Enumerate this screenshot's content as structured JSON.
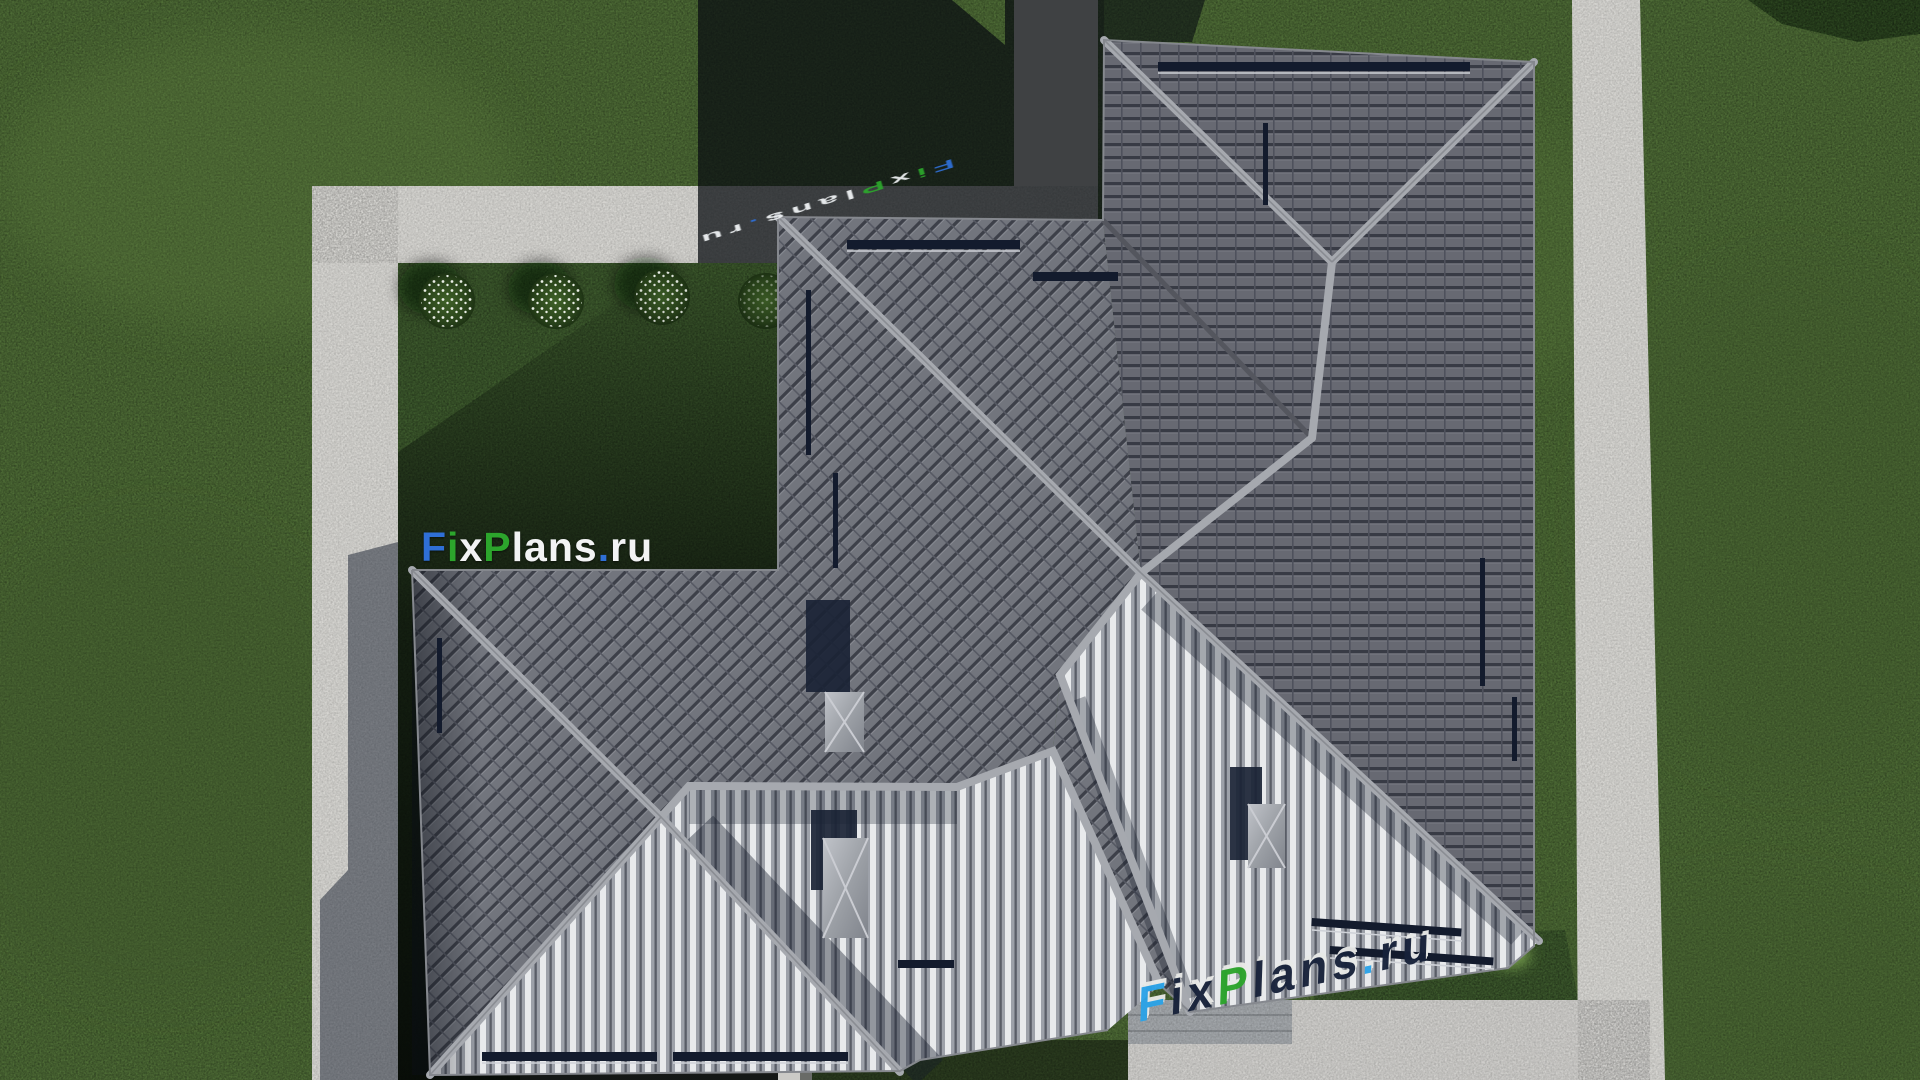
{
  "watermarks": {
    "logo_text": "FixPlans.ru",
    "letters": [
      {
        "ch": "F",
        "c": "blue"
      },
      {
        "ch": "i",
        "c": "green"
      },
      {
        "ch": "x",
        "c": "white"
      },
      {
        "ch": "P",
        "c": "green"
      },
      {
        "ch": "l",
        "c": "white"
      },
      {
        "ch": "a",
        "c": "white"
      },
      {
        "ch": "n",
        "c": "white"
      },
      {
        "ch": "s",
        "c": "white"
      },
      {
        "ch": ".",
        "c": "blue"
      },
      {
        "ch": "r",
        "c": "white"
      },
      {
        "ch": "u",
        "c": "white"
      }
    ]
  },
  "palette": {
    "lawn": "#4e6c36",
    "lawnLight": "#617f41",
    "lawnDark": "#3c5429",
    "bedGreen": "#3d5a2d",
    "hedge": "#2c4620",
    "path": "#d6d5d1",
    "driveway": "#cfcecb",
    "wall": "#a3a7ab",
    "terrace": "#cbcac6",
    "tileBase": "#72757d",
    "tileLine": "#3d4049",
    "tileSeam": "#565963",
    "ridge": "#a6a9af",
    "ridgeEdge": "#83868c",
    "valley": "#54565e",
    "stripeLight": "#e8eaec",
    "stripeMid": "#9da1a9",
    "stripeDark": "#595d66",
    "snowbar": "#131b2d",
    "rail": "#cfd2d8",
    "chimneyCap": "#9da1a7",
    "chimneyCapLight": "#c0c3c9",
    "chimneyShadow": "#1a2335",
    "bush": "#2f4d20",
    "flower": "#eaefe6",
    "bushSmall": "#79a24f",
    "logoWhite": "#f2f3f4",
    "logoBlue": "#2f6fd6",
    "logoGreen": "#2ca52c",
    "logoBrightBlue": "#2ba3e8",
    "navyText": "#17223a"
  }
}
